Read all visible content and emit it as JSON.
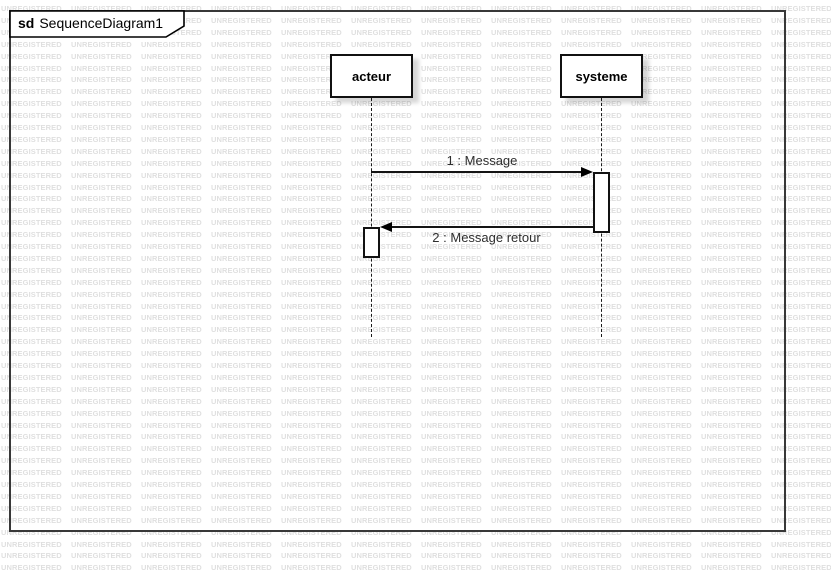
{
  "watermark": {
    "text": "UNREGISTERED",
    "color": "#dfdfdf"
  },
  "frame": {
    "keyword": "sd",
    "title": "SequenceDiagram1",
    "border_color": "#383838"
  },
  "lifelines": [
    {
      "name": "acteur"
    },
    {
      "name": "systeme"
    }
  ],
  "messages": [
    {
      "label": "1 : Message",
      "from": "acteur",
      "to": "systeme",
      "direction": "right"
    },
    {
      "label": "2 : Message retour",
      "from": "systeme",
      "to": "acteur",
      "direction": "left"
    }
  ],
  "colors": {
    "background": "#ffffff",
    "element_border": "#111111",
    "message_line": "#141414",
    "message_text": "#2e2e2e"
  }
}
